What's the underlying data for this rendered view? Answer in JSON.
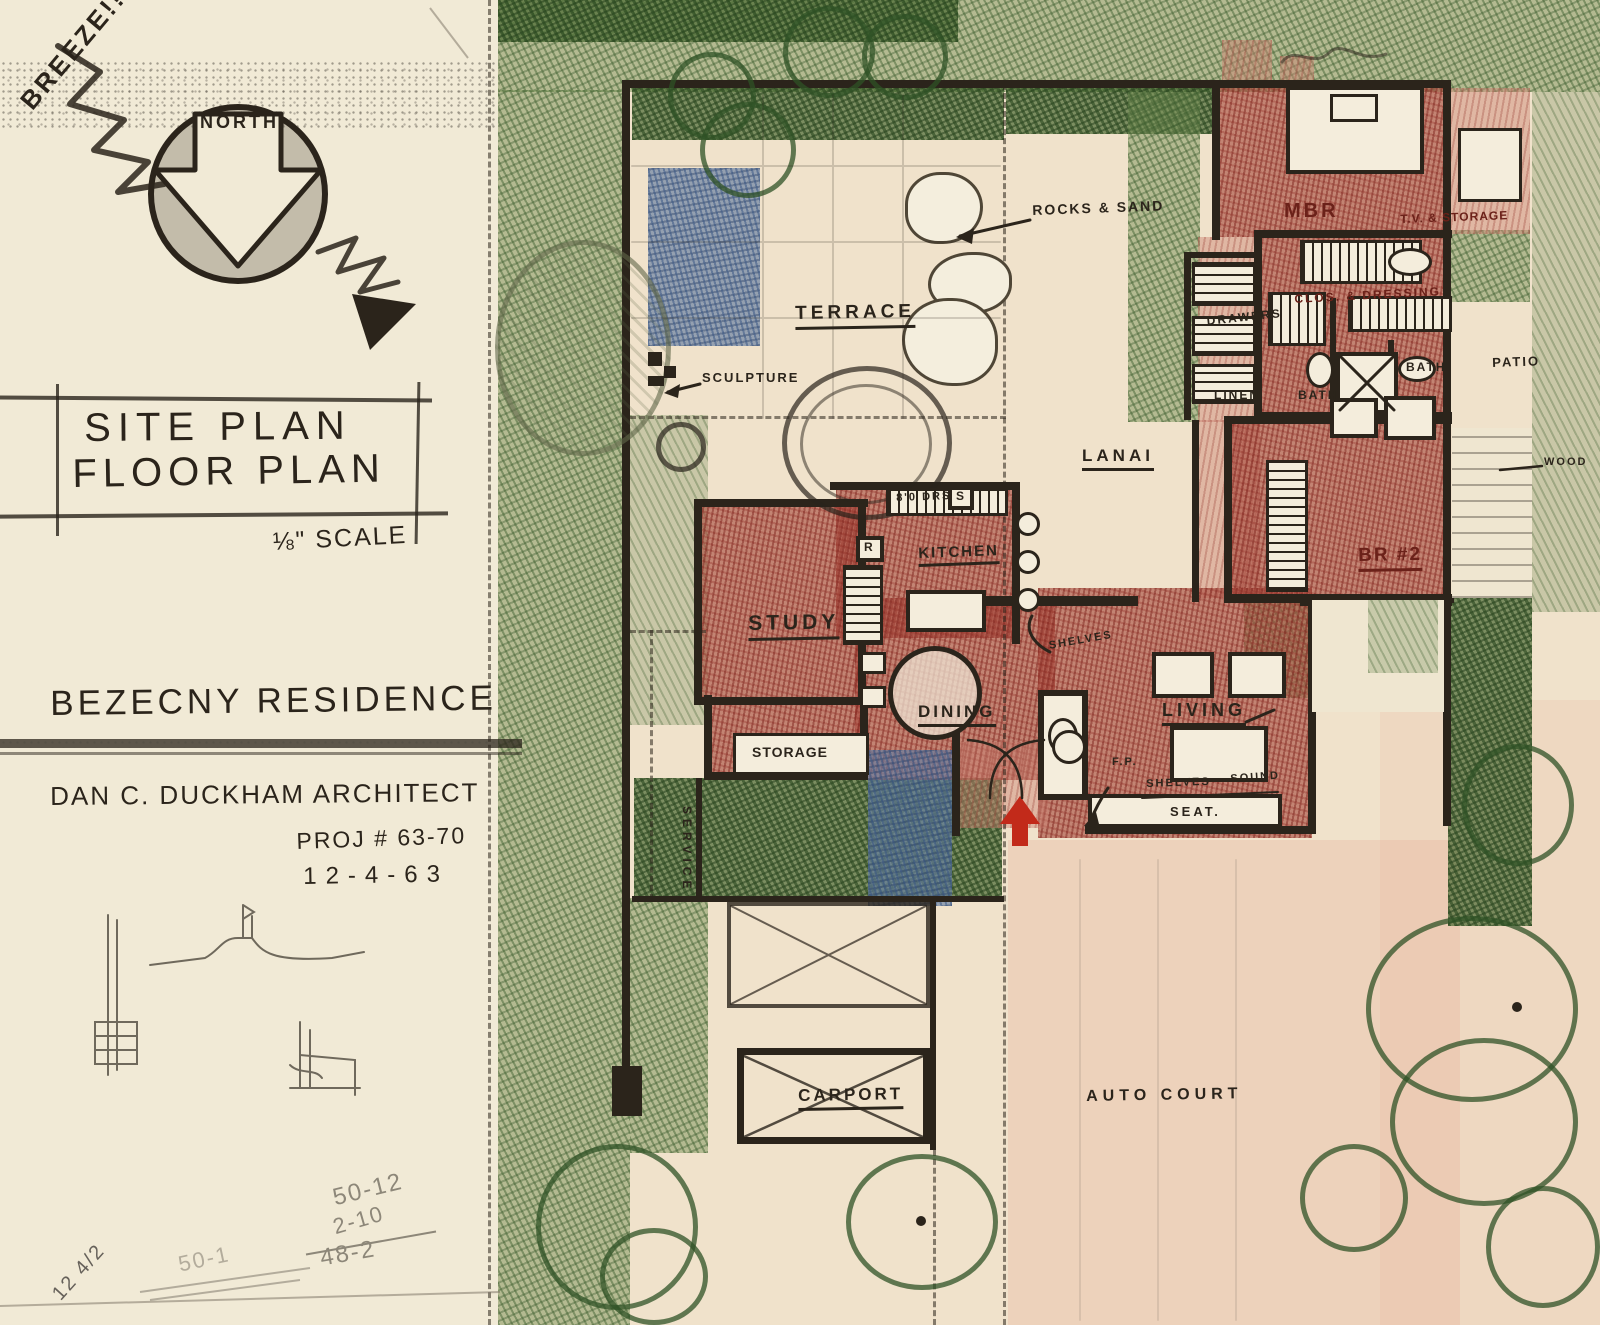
{
  "sheet": {
    "description": "Hand-drawn architectural site plan and floor plan sketch, crayon on paper"
  },
  "left_panel": {
    "breeze": "BREEZE!!",
    "north": "NORTH",
    "title_line1": "SITE PLAN",
    "title_line2": "FLOOR PLAN",
    "scale": "⅛\" SCALE",
    "residence": "BEZECNY RESIDENCE",
    "architect": "DAN C. DUCKHAM ARCHITECT",
    "project": "PROJ # 63-70",
    "date": "12-4-63",
    "calc_note_1": "50-12",
    "calc_note_2": "2-10",
    "calc_note_3": "48-2",
    "faint_note": "50-1",
    "corner_note": "12 4/2"
  },
  "plan_labels": {
    "terrace": "TERRACE",
    "sculpture": "SCULPTURE",
    "rocks_sand": "ROCKS & SAND",
    "mbr": "MBR",
    "tv_storage": "T.V. & STORAGE",
    "clos_dressing": "CLOS. & DRESSING",
    "drawers": "DRAWERS",
    "linen": "LINEN",
    "bath_master": "BATH",
    "bath_hall": "BATH",
    "patio_upper": "PATIO",
    "patio_lower": "PATIO",
    "lanai": "LANAI",
    "br2": "BR #2",
    "wood": "WOOD",
    "kitchen": "KITCHEN",
    "door_note": "8'0 DRS",
    "switch": "S",
    "range": "R",
    "study": "STUDY",
    "dining": "DINING",
    "shelves_a": "SHELVES",
    "shelves_b": "SHELVES",
    "sound": "SOUND",
    "fireplace": "F.P.",
    "living": "LIVING",
    "seat": "SEAT.",
    "storage": "STORAGE",
    "service": "SERVICE",
    "carport": "CARPORT",
    "auto_court": "AUTO COURT"
  },
  "colors": {
    "paper": "#f1ead6",
    "ink": "#2b241b",
    "crayon_green": "#4a6b33",
    "crayon_red": "#9e3a30",
    "crayon_blue": "#5b79a2",
    "entry_arrow": "#c22a1a",
    "pencil": "#8d8779",
    "red_ink": "#6b2119"
  }
}
